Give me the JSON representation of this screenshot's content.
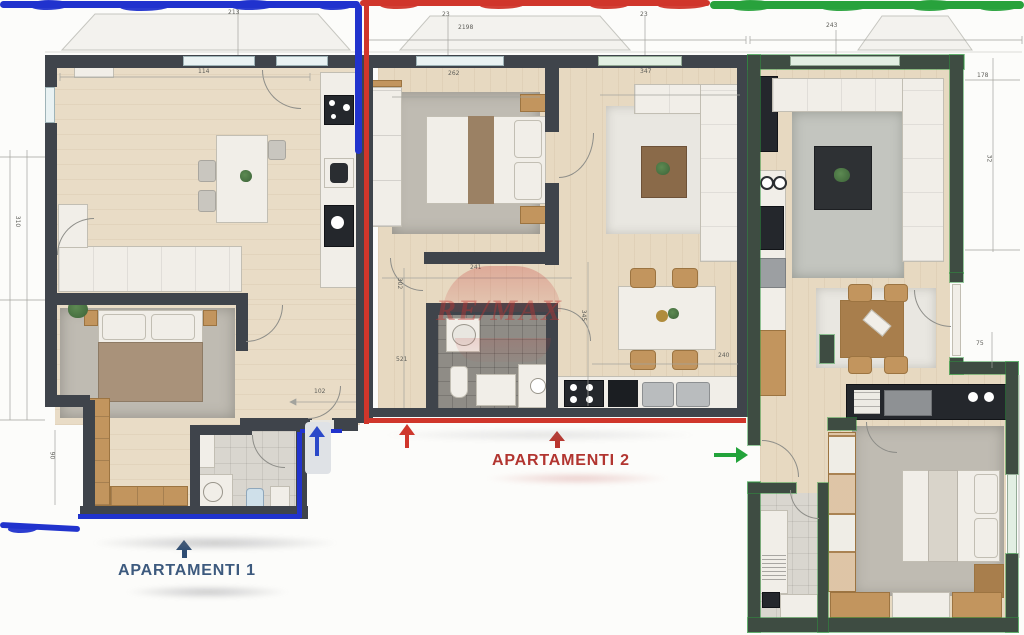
{
  "plan": {
    "watermark": {
      "text": "RE/MAX",
      "color": "#c23b3b"
    },
    "apartment1": {
      "label": "APARTAMENTI 1",
      "label_color": "#3d5a7e",
      "marker_color": "#2133cd"
    },
    "apartment2": {
      "label": "APARTAMENTI 2",
      "label_color": "#b23530",
      "marker_color": "#d0362b"
    },
    "apartment3": {
      "marker_color": "#28a23c"
    },
    "dims": [
      {
        "t": "213"
      },
      {
        "t": "23"
      },
      {
        "t": "2198"
      },
      {
        "t": "23"
      },
      {
        "t": "243"
      },
      {
        "t": "178"
      },
      {
        "t": "32"
      },
      {
        "t": "310"
      },
      {
        "t": "114"
      },
      {
        "t": "262"
      },
      {
        "t": "347"
      },
      {
        "t": "241"
      },
      {
        "t": "302"
      },
      {
        "t": "521"
      },
      {
        "t": "345"
      },
      {
        "t": "240"
      },
      {
        "t": "102"
      },
      {
        "t": "90"
      },
      {
        "t": "75"
      }
    ]
  }
}
